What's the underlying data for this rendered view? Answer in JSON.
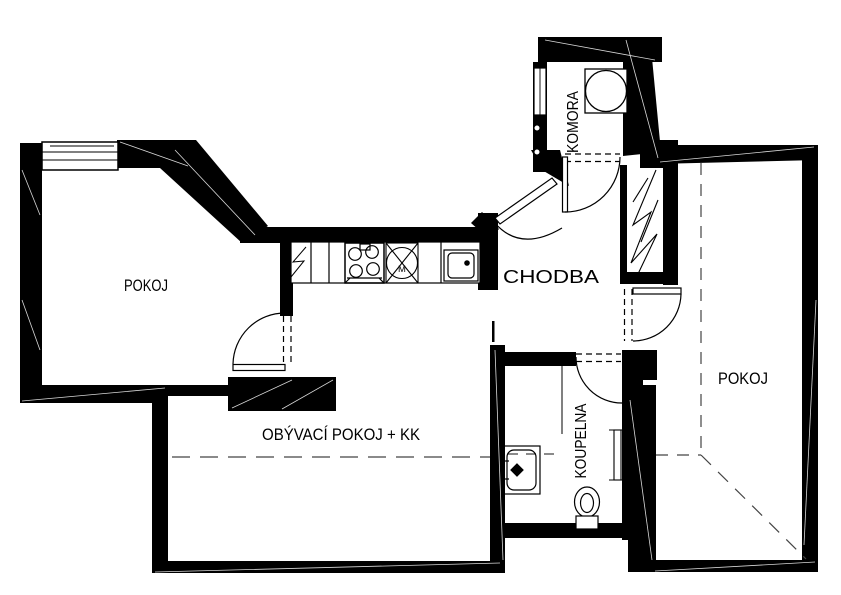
{
  "drawing_type": "apartment floor plan",
  "colors": {
    "background": "#ffffff",
    "ink": "#000000"
  },
  "rooms": {
    "pokoj_left": {
      "label": "POKOJ"
    },
    "obyvaci": {
      "label": "OBÝVACÍ POKOJ + KK"
    },
    "chodba": {
      "label": "CHODBA"
    },
    "komora": {
      "label": "KOMORA"
    },
    "koupelna": {
      "label": "KOUPELNA"
    },
    "pokoj_right": {
      "label": "POKOJ"
    }
  },
  "fixtures": {
    "dishwasher_label": "M",
    "icons": [
      "fridge-cabinet",
      "stove",
      "dishwasher",
      "kitchen-sink",
      "washing-machine",
      "washbasin",
      "toilet",
      "radiator",
      "ventilation-shaft"
    ]
  },
  "doors": [
    "entrance-door",
    "komora-door",
    "pokoj-left-door",
    "pokoj-right-door",
    "koupelna-door"
  ],
  "windows": [
    "pokoj-left-window",
    "komora-window"
  ],
  "annotations": {
    "dashed_lines": "ceiling slope / opening markers"
  }
}
